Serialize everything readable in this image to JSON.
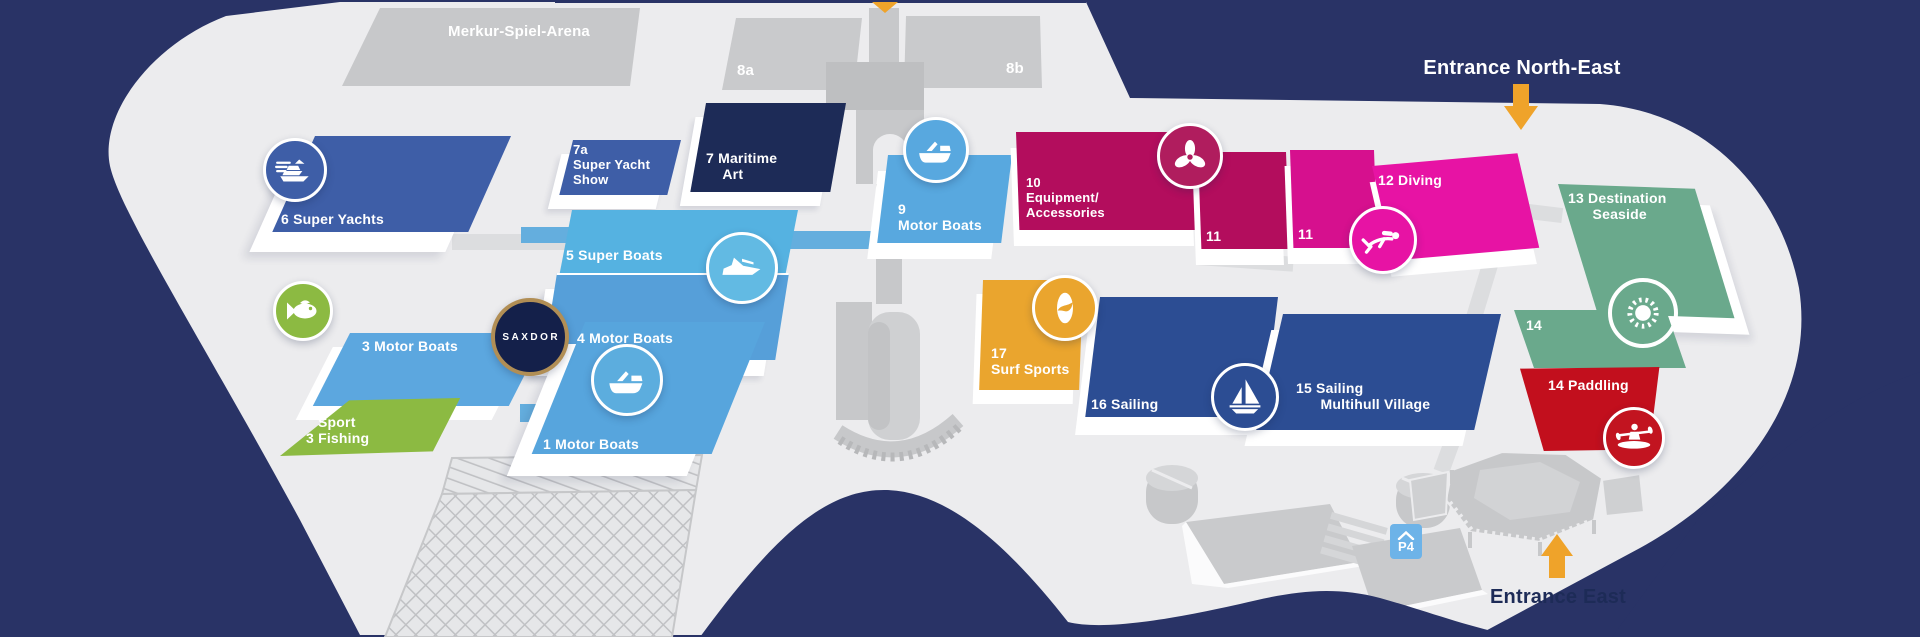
{
  "arena_label": "Merkur-Spiel-Arena",
  "service_halls": [
    {
      "label": "8a"
    },
    {
      "label": "8b"
    }
  ],
  "entrances": {
    "north_east": "Entrance North-East",
    "east": "Entrance East"
  },
  "parking": {
    "label": "P4"
  },
  "brand": {
    "label": "SAXDOR"
  },
  "halls": [
    {
      "id": "6",
      "name": "Super Yachts",
      "label": "6 Super Yachts",
      "color": "#3e5ea7",
      "icon": "super-yacht-icon"
    },
    {
      "id": "7a",
      "name": "Super Yacht Show",
      "label": "7a\nSuper Yacht\nShow",
      "color": "#3e5ea7"
    },
    {
      "id": "7",
      "name": "Maritime Art",
      "label": "7 Maritime\n    Art",
      "color": "#1d2b57"
    },
    {
      "id": "5",
      "name": "Super Boats",
      "label": "5 Super Boats",
      "color": "#55b2e1",
      "icon": "speedboat-icon"
    },
    {
      "id": "4",
      "name": "Motor Boats",
      "label": "4 Motor Boats",
      "color": "#569fd9"
    },
    {
      "id": "3",
      "name": "Motor Boats",
      "label": "3 Motor Boats",
      "color": "#5ca7df"
    },
    {
      "id": "3f",
      "name": "Sport Fishing",
      "label": "Sport\n3 Fishing",
      "color": "#8cba42",
      "icon": "fish-icon"
    },
    {
      "id": "1",
      "name": "Motor Boats",
      "label": "1 Motor Boats",
      "color": "#57a5dd",
      "icon": "motorboat-icon"
    },
    {
      "id": "9",
      "name": "Motor Boats",
      "label": "9\nMotor Boats",
      "color": "#58a8df",
      "icon": "motorboat-icon"
    },
    {
      "id": "10",
      "name": "Equipment/Accessories",
      "label": "10\nEquipment/\nAccessories",
      "color": "#b30d5d",
      "icon": "propeller-icon"
    },
    {
      "id": "11",
      "name": "Hall 11",
      "label": "11",
      "color": "#b30d5d"
    },
    {
      "id": "11",
      "name": "Hall 11",
      "label": "11",
      "color": "#d6108e"
    },
    {
      "id": "12",
      "name": "Diving",
      "label": "12 Diving",
      "color": "#e713a4",
      "icon": "diver-icon"
    },
    {
      "id": "13",
      "name": "Destination Seaside",
      "label": "13 Destination\n      Seaside",
      "color": "#6aa98c",
      "icon": "sun-icon"
    },
    {
      "id": "14",
      "name": "Hall 14",
      "label": "14",
      "color": "#6aa98c"
    },
    {
      "id": "14",
      "name": "Paddling",
      "label": "14 Paddling",
      "color": "#c20f1d",
      "icon": "kayak-icon"
    },
    {
      "id": "15",
      "name": "Sailing Multihull Village",
      "label": "15 Sailing\n      Multihull Village",
      "color": "#2c4d93"
    },
    {
      "id": "16",
      "name": "Sailing",
      "label": "16 Sailing",
      "color": "#2c4d93",
      "icon": "sailboat-icon"
    },
    {
      "id": "17",
      "name": "Surf Sports",
      "label": "17\nSurf Sports",
      "color": "#eaa52e",
      "icon": "surfboard-icon"
    }
  ],
  "colors": {
    "background_navy": "#293366",
    "venue_gray": "#ececee",
    "building_gray": "#c7c8ca",
    "water_blue": "#64aede",
    "accent_orange": "#efa32a",
    "white": "#ffffff",
    "saxdor_gold": "#b18e55",
    "parking_blue": "#6db3e8"
  }
}
